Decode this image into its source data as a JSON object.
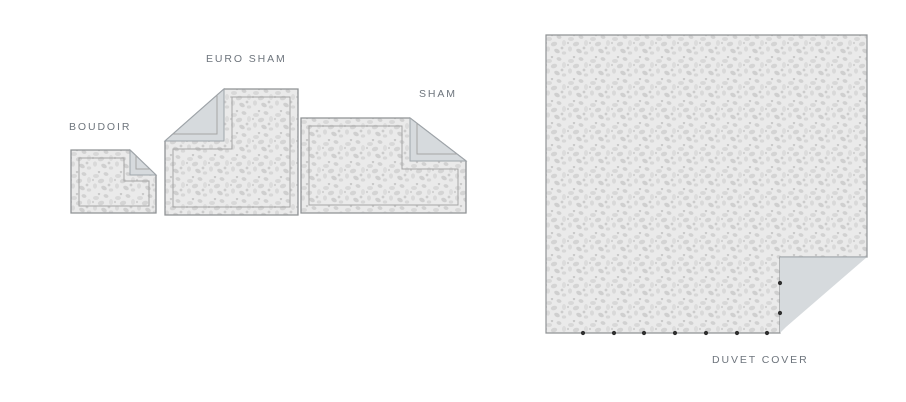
{
  "items": [
    {
      "id": "boudoir",
      "label": "BOUDOIR"
    },
    {
      "id": "euro-sham",
      "label": "EURO SHAM"
    },
    {
      "id": "sham",
      "label": "SHAM"
    },
    {
      "id": "duvet-cover",
      "label": "DUVET COVER"
    }
  ],
  "colors": {
    "background": "#ffffff",
    "label-text": "#6e757d",
    "fabric_base": "#eaeaea",
    "outline": "#8f9295",
    "stitch": "#a5a5a5",
    "fold_back": "#d6dadd",
    "fold_outline": "#9fa5aa",
    "button_dot": "#2f2f2f"
  }
}
